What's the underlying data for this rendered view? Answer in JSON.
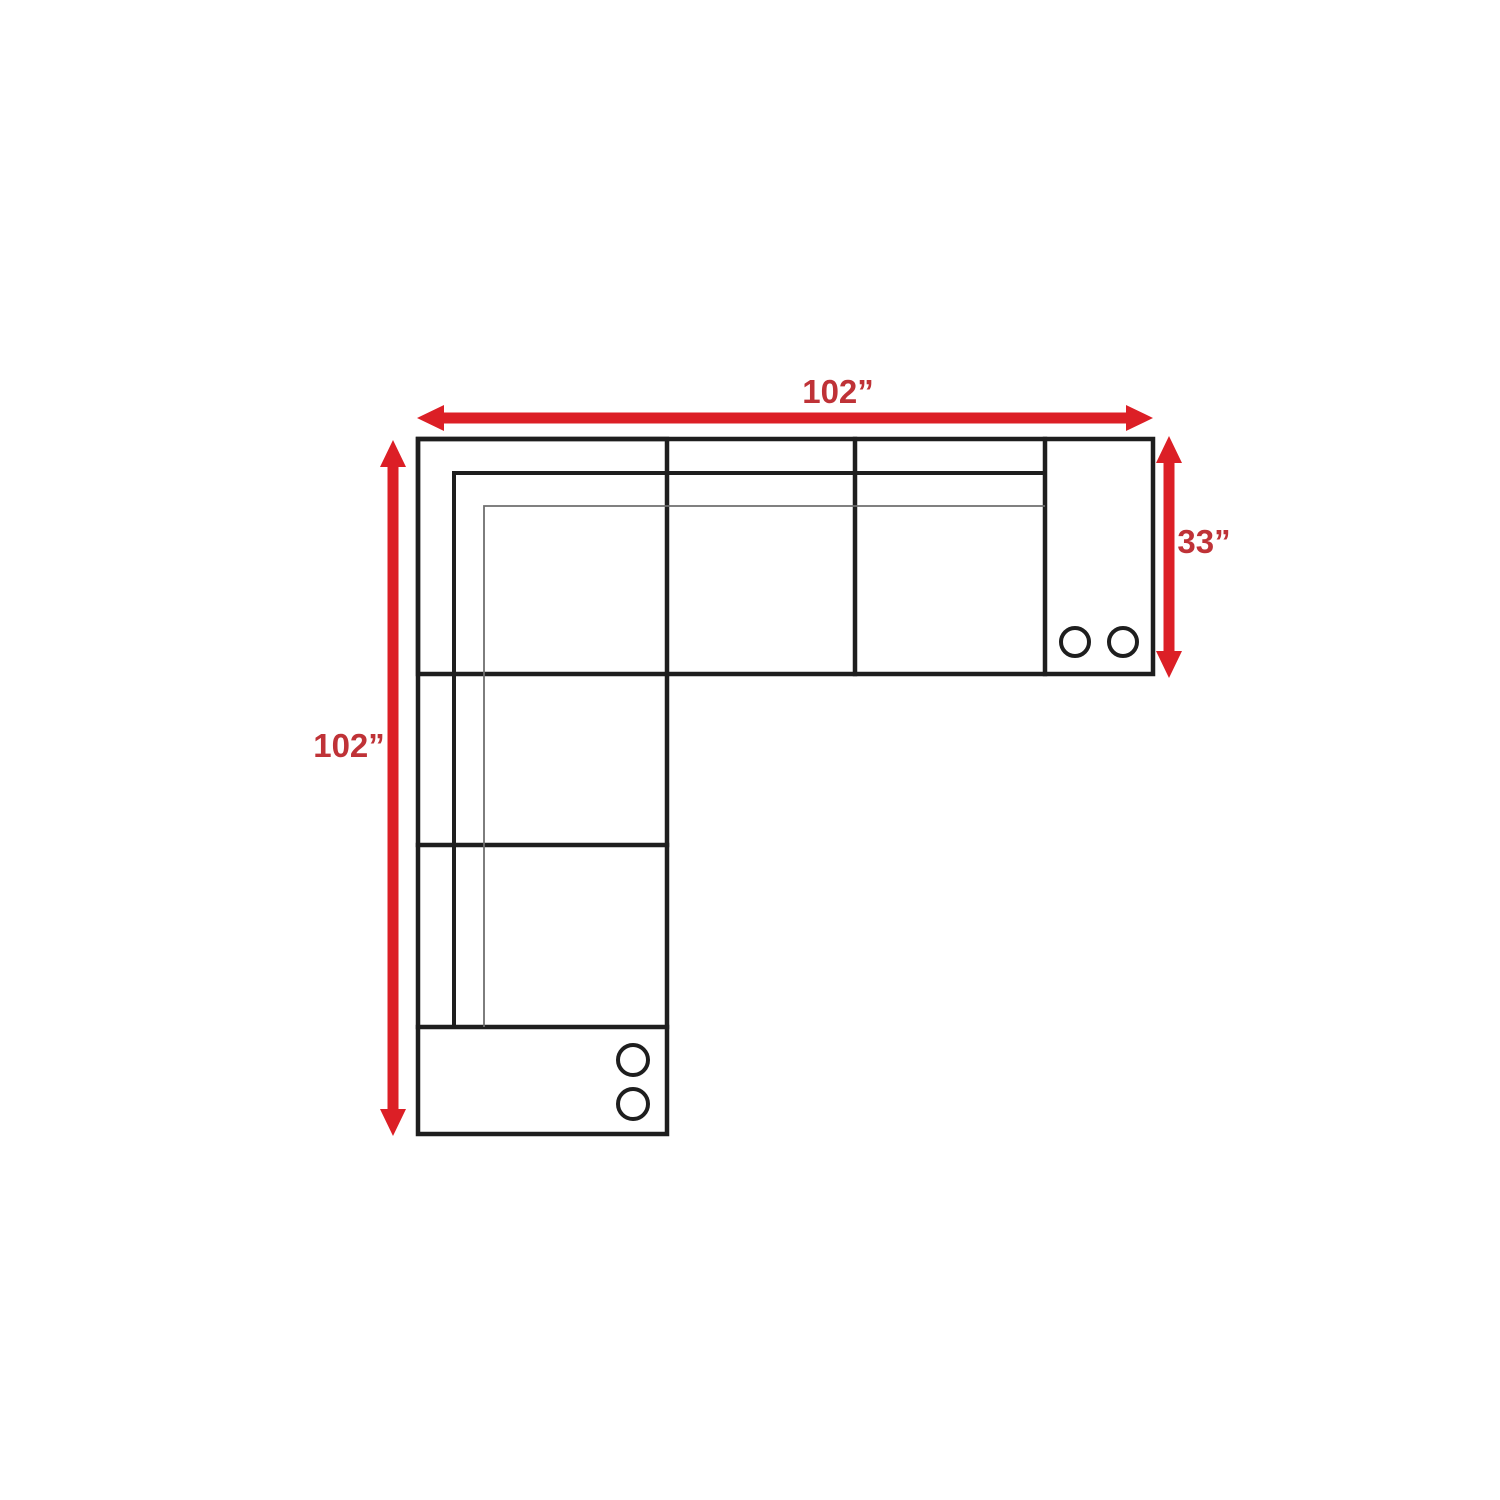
{
  "diagram": {
    "labels": {
      "top_width": "102”",
      "left_length": "102”",
      "right_depth": "33”"
    },
    "colors": {
      "arrow_red": "#dc1f26",
      "label_red": "#bf3237",
      "outline_dark": "#1e1e1e",
      "seat_line_gray": "#6f6f6f",
      "background": "#ffffff"
    },
    "icons": {
      "cup_holder": "circle"
    }
  }
}
